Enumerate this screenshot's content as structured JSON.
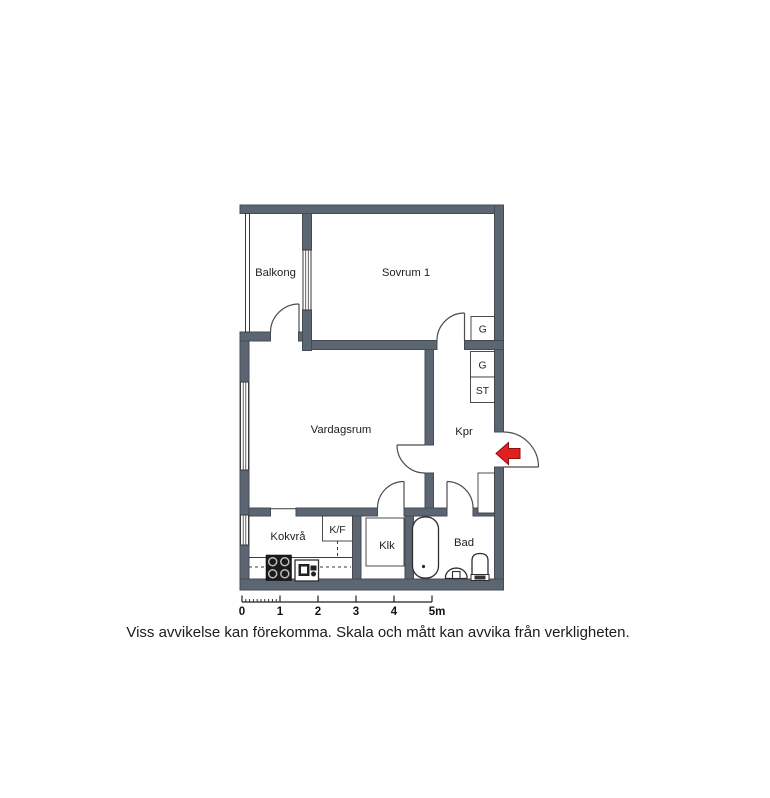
{
  "plan": {
    "rooms": [
      {
        "id": "balkong",
        "label": "Balkong"
      },
      {
        "id": "sovrum-1",
        "label": "Sovrum 1"
      },
      {
        "id": "vardagsrum",
        "label": "Vardagsrum"
      },
      {
        "id": "kpr",
        "label": "Kpr"
      },
      {
        "id": "kokvra",
        "label": "Kokvrå"
      },
      {
        "id": "klk",
        "label": "Klk"
      },
      {
        "id": "bad",
        "label": "Bad"
      }
    ],
    "closets": [
      {
        "id": "garderob-sovrum",
        "label": "G"
      },
      {
        "id": "garderob-kpr",
        "label": "G"
      },
      {
        "id": "stadskap-kpr",
        "label": "ST"
      }
    ],
    "kitchen": {
      "fridge_freezer_label": "K/F"
    },
    "entrance": {
      "marker_icon": "entrance-arrow-left"
    }
  },
  "scale_bar": {
    "tick_labels": [
      "0",
      "1",
      "2",
      "3",
      "4",
      "5m"
    ],
    "unit": "m"
  },
  "disclaimer": "Viss avvikelse kan förekomma. Skala och mått kan avvika från verkligheten.",
  "colors": {
    "wall": "#5c6572",
    "wall-outline": "#454b55",
    "line": "#3a3a3a",
    "door": "#4c4c4c",
    "fixture": "#2e2e2e",
    "arrow": "#e32020",
    "arrow-outline": "#8e1010",
    "text": "#1f1f1f"
  }
}
